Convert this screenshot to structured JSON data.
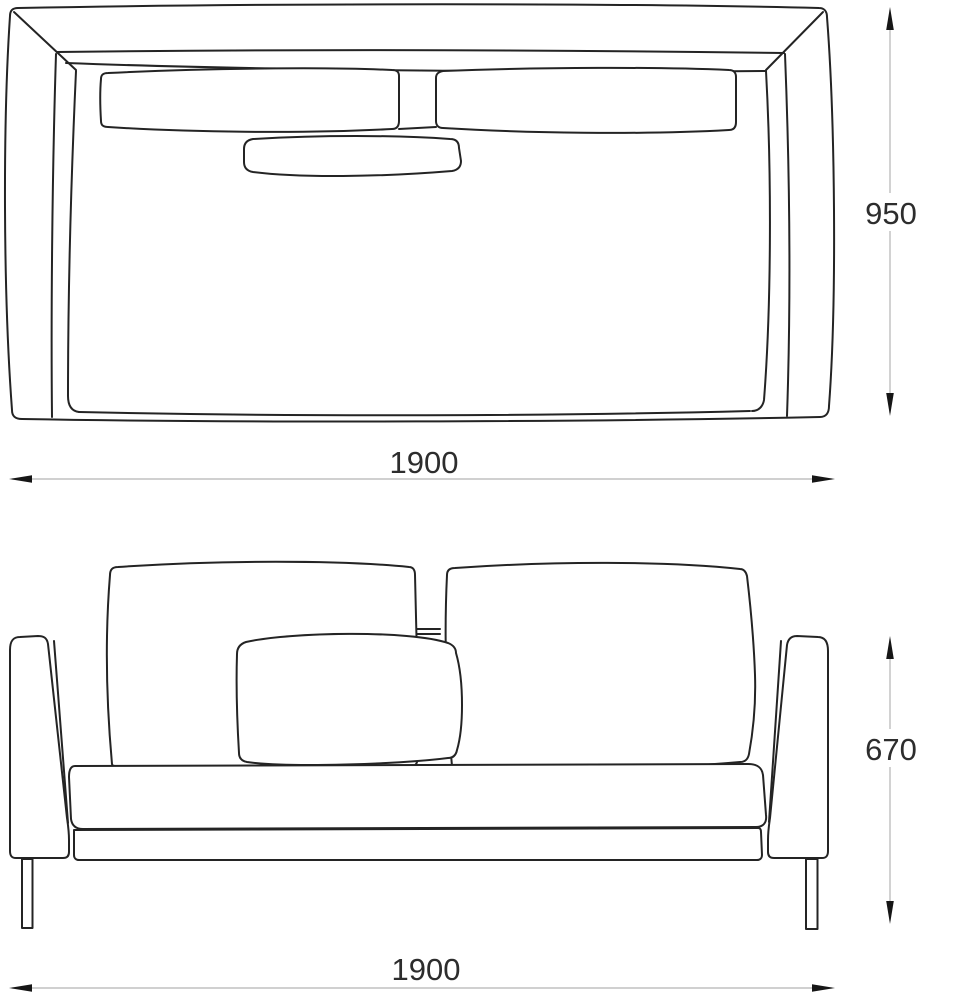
{
  "colors": {
    "background": "#ffffff",
    "line": "#242424",
    "dimline": "#b5b5b5",
    "arrow": "#161616",
    "label": "#2d2d2d"
  },
  "drawing": {
    "type": "furniture-technical-drawing",
    "subject": "two-seat sofa",
    "views": {
      "top": {
        "name": "top view"
      },
      "front": {
        "name": "front view"
      }
    }
  },
  "dimensions": {
    "top_depth": "950",
    "top_width": "1900",
    "front_height": "670",
    "front_width": "1900"
  }
}
